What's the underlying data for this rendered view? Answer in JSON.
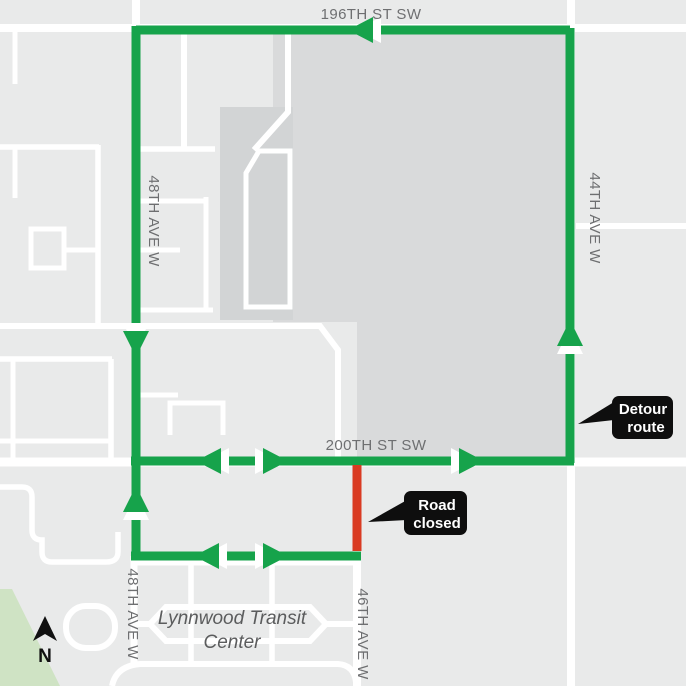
{
  "map": {
    "title": "Road closure and detour map",
    "streets": {
      "st_196": "196TH ST SW",
      "st_200": "200TH ST SW",
      "ave_48_top": "48TH AVE W",
      "ave_48_bottom": "48TH AVE W",
      "ave_44": "44TH AVE W",
      "ave_46": "46TH AVE W"
    },
    "places": {
      "transit_line1": "Lynnwood Transit",
      "transit_line2": "Center"
    },
    "callouts": {
      "detour": {
        "line1": "Detour",
        "line2": "route"
      },
      "closed": {
        "line1": "Road",
        "line2": "closed"
      }
    },
    "compass": {
      "label": "N"
    },
    "colors": {
      "background": "#e9eaea",
      "block": "#d9dadb",
      "block_strip": "#d2d4d5",
      "road": "#ffffff",
      "detour_route": "#16a34b",
      "road_closed": "#d93b22",
      "park": "#cfe3c4",
      "street_label": "#6e6f71",
      "place_label": "#5b5c5d",
      "callout_bg": "#0e0e0e",
      "callout_text": "#ffffff",
      "compass": "#111111"
    }
  }
}
